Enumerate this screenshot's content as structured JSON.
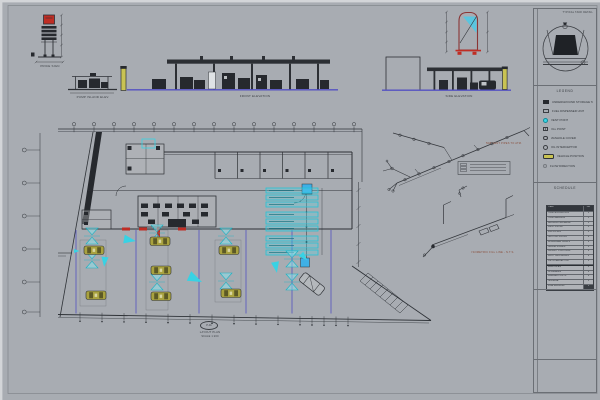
{
  "colors": {
    "bg": "#a8acb2",
    "cyan": "#38d2e4",
    "purple": "#4f4fc0",
    "red": "#bf2d24",
    "yellow": "#c9c353",
    "ink": "#2e3136"
  },
  "captions": {
    "totem": "PRICE SIGN",
    "left_elev": "PUMP ISLAND ELEV.",
    "main_elev": "FRONT ELEVATION",
    "right_elev": "SIDE ELEVATION",
    "iso1": "50Ø VENT PIPES TO ATM.",
    "iso2": "ISOMETRIC FILL LINE - N.T.S.",
    "detail": "TYPICAL TANK DETAIL"
  },
  "plan": {
    "title": "LAYOUT PLAN",
    "scale_label": "SCALE 1:200",
    "bubble": "P-01",
    "grid_top_xs": [
      74,
      94,
      114,
      134,
      154,
      174,
      194,
      214,
      234,
      254,
      274,
      294,
      314,
      334,
      354
    ],
    "grid_left_ys": [
      150,
      183,
      216,
      249,
      282,
      312
    ],
    "bottom_tick_xs": [
      80,
      102,
      124,
      146,
      168,
      190,
      212,
      234,
      256,
      278,
      300,
      312,
      324,
      336,
      348
    ],
    "lane_xs": [
      76,
      136,
      199,
      246,
      292,
      331
    ],
    "tanks_ys": [
      188,
      195,
      202,
      212,
      219,
      226,
      236,
      243,
      250
    ],
    "dispensers": [
      [
        92,
        236
      ],
      [
        92,
        260
      ],
      [
        157,
        233
      ],
      [
        157,
        282
      ],
      [
        226,
        236
      ],
      [
        226,
        281
      ],
      [
        292,
        259
      ],
      [
        292,
        282
      ]
    ],
    "arrows": [
      [
        124,
        239,
        10,
        1.1
      ],
      [
        105,
        257,
        95,
        0.9
      ],
      [
        189,
        276,
        25,
        1.3
      ],
      [
        275,
        262,
        80,
        1.0
      ],
      [
        301,
        254,
        45,
        0.8
      ],
      [
        74,
        251,
        0,
        0.5
      ]
    ],
    "cars_yellow": [
      [
        84,
        246
      ],
      [
        150,
        237
      ],
      [
        219,
        246
      ],
      [
        86,
        291
      ],
      [
        151,
        266
      ],
      [
        151,
        292
      ],
      [
        221,
        289
      ]
    ],
    "car_gray": {
      "x": 312,
      "y": 284,
      "rot": 38
    }
  },
  "title_block": {
    "legend": {
      "title": "LEGEND",
      "items": [
        {
          "label": "UNDERGROUND STORAGE TANK"
        },
        {
          "label": "FUEL DISPENSER UNIT"
        },
        {
          "label": "VENT POINT"
        },
        {
          "label": "FILL POINT"
        },
        {
          "label": "MANHOLE COVER"
        },
        {
          "label": "OIL INTERCEPTOR"
        },
        {
          "label": "VEHICLE POSITION"
        },
        {
          "label": "FLOW DIRECTION"
        }
      ]
    },
    "schedule": {
      "title": "SCHEDULE",
      "header": {
        "c1": "ITEM",
        "c2": "NO"
      },
      "rows_a": [
        {
          "d": "TANK EXCAVATION",
          "q": "1"
        },
        {
          "d": "TANK BEDDING",
          "q": "1"
        },
        {
          "d": "BACKFILL MATERIAL",
          "q": "1"
        },
        {
          "d": "VENT PIPING",
          "q": "4"
        },
        {
          "d": "FILL PIPING",
          "q": "4"
        },
        {
          "d": "SUCTION PIPING",
          "q": "8"
        },
        {
          "d": "DISPENSER SUMPS",
          "q": "6"
        },
        {
          "d": "ISLAND FORMS",
          "q": "3"
        },
        {
          "d": "CANOPY FOOTINGS",
          "q": "6"
        },
        {
          "d": "DUCT CROSSINGS",
          "q": "2"
        },
        {
          "d": "OIL INTERCEPTOR",
          "q": "1"
        }
      ],
      "rows_b": [
        {
          "d": "MANHOLES",
          "q": "4"
        },
        {
          "d": "CHAMBERS",
          "q": "2"
        },
        {
          "d": "MARKER POSTS",
          "q": "6"
        },
        {
          "d": "SIGNAGE",
          "q": "1"
        },
        {
          "d": "LINE MARKING",
          "q": "1"
        }
      ]
    }
  }
}
